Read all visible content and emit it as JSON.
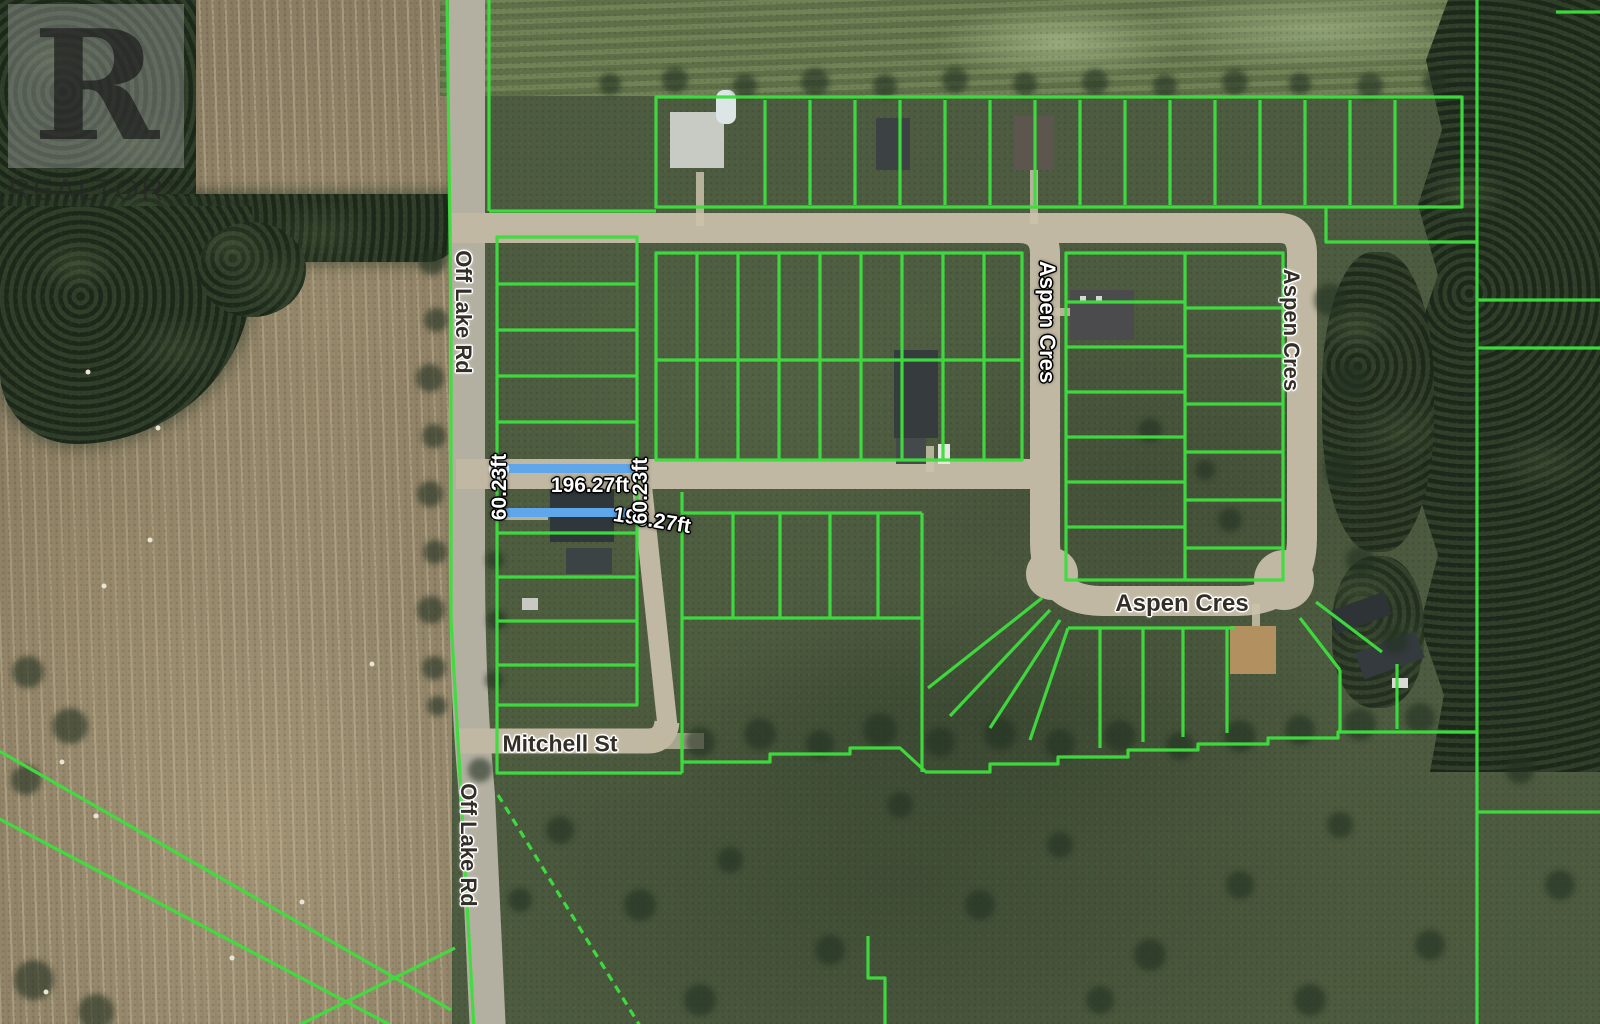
{
  "window": {
    "type": "satellite-map-listing-photo"
  },
  "watermark": {
    "logo_letter": "R",
    "brand": "REALTOR",
    "registered": "®"
  },
  "map": {
    "street_labels": [
      {
        "id": "off-lake-rd-north",
        "text": "Off Lake Rd"
      },
      {
        "id": "off-lake-rd-south",
        "text": "Off Lake Rd"
      },
      {
        "id": "mitchell-st",
        "text": "Mitchell St"
      },
      {
        "id": "aspen-cres-west",
        "text": "Aspen Cres"
      },
      {
        "id": "aspen-cres-east",
        "text": "Aspen Cres"
      },
      {
        "id": "aspen-cres-south",
        "text": "Aspen Cres"
      }
    ],
    "measurements": {
      "frontage_top": "196.27ft",
      "frontage_bottom": "196.27ft",
      "depth_left": "60.23ft",
      "depth_right": "60.23ft"
    },
    "colors": {
      "parcel-line": "#3edd3e",
      "highlight-line": "#5fa6ea",
      "road-fill": "#c0b8a2",
      "label-dark": "#332e28",
      "label-light": "#ffffff"
    }
  }
}
